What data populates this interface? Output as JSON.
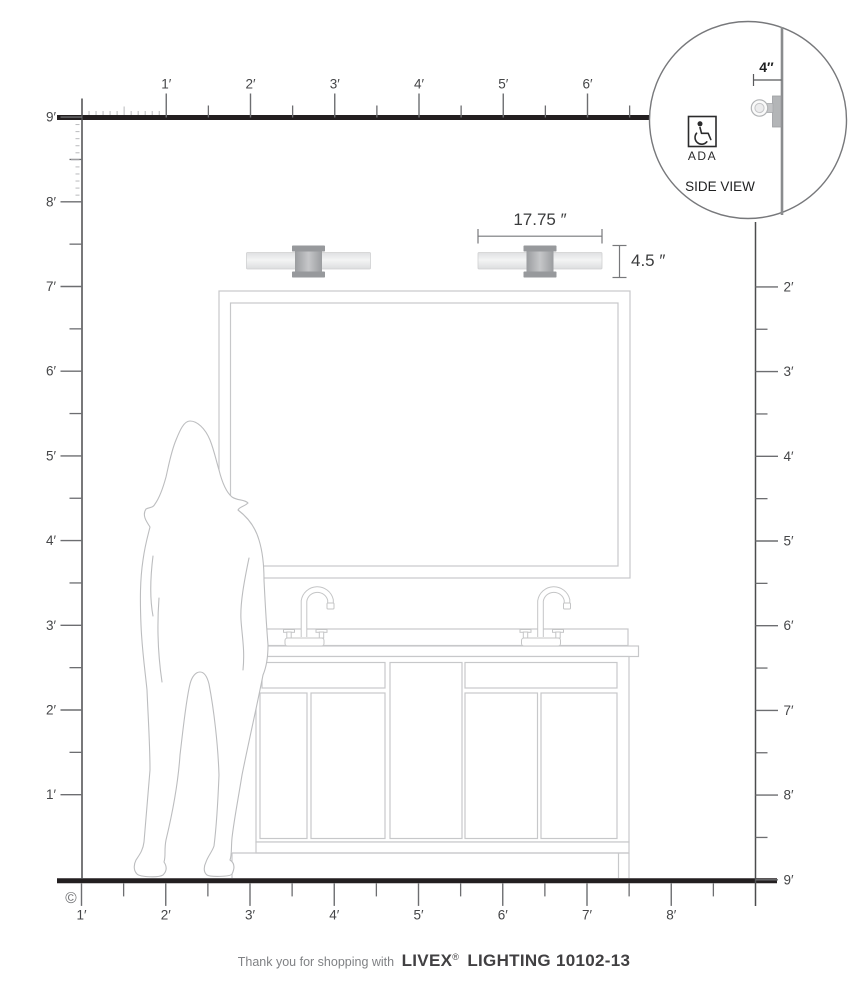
{
  "page": {
    "copyright_symbol": "©"
  },
  "rulers": {
    "top_labels": [
      "1′",
      "2′",
      "3′",
      "4′",
      "5′",
      "6′"
    ],
    "left_labels": [
      "9′",
      "8′",
      "7′",
      "6′",
      "5′",
      "4′",
      "3′",
      "2′",
      "1′"
    ],
    "right_labels": [
      "2′",
      "3′",
      "4′",
      "5′",
      "6′",
      "7′",
      "8′",
      "9′"
    ],
    "bottom_labels": [
      "8′",
      "7′",
      "6′",
      "5′",
      "4′",
      "3′",
      "2′",
      "1′"
    ]
  },
  "dimensions": {
    "fixture_width": "17.75 ″",
    "fixture_height": "4.5 ″",
    "wall_offset": "4″"
  },
  "inset": {
    "ada_label": "ADA",
    "side_view_label": "SIDE VIEW"
  },
  "footer": {
    "prefix": "Thank you for shopping with",
    "brand": "LIVEX",
    "reg_mark": "®",
    "suffix": "LIGHTING 10102-13"
  },
  "colors": {
    "heavy_line": "#231f20",
    "ruler_line": "#58595b",
    "drawing_line": "#c7c8ca",
    "fixture_light": "#eeeff0",
    "fixture_mount": "#97999c",
    "dim_line": "#77787b"
  }
}
